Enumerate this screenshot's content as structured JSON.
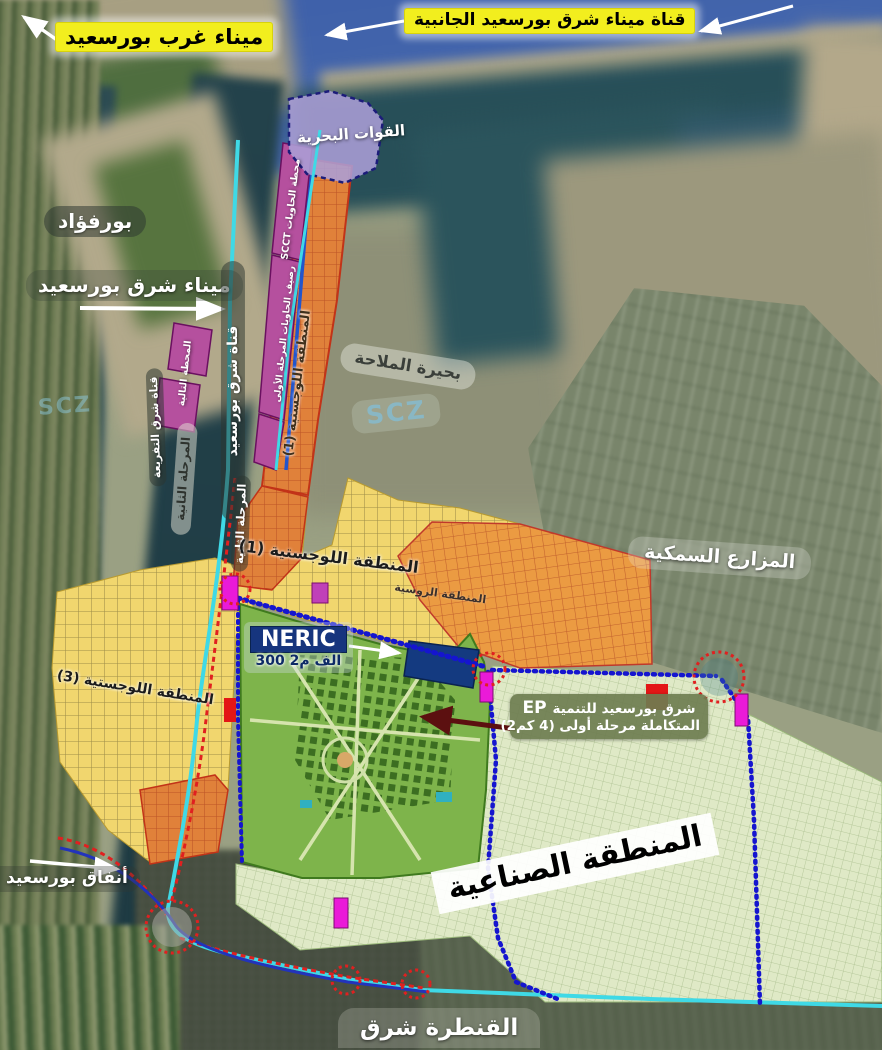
{
  "title": "East Port Said development master plan (satellite overlay)",
  "watermark": "SCZ",
  "labels": {
    "port_west": {
      "text": "ميناء غرب بورسعيد"
    },
    "side_canal": {
      "text": "قناة ميناء شرق بورسعيد الجانبية"
    },
    "navy_forces": {
      "text": "القوات البحرية"
    },
    "port_fuad": {
      "text": "بورفؤاد"
    },
    "port_east": {
      "text": "ميناء شرق بورسعيد"
    },
    "canal_east": {
      "text": "قناة شرق بورسعيد"
    },
    "canal_branch": {
      "text": "قناة شرق التفريعة"
    },
    "phase2_west": {
      "text": "المرحلة الثانية"
    },
    "phase2_east": {
      "text": "المرحلة الثانية"
    },
    "scct_terminal": {
      "text": "محطة الحاويات SCCT"
    },
    "container_quay": {
      "text": "رصيف الحاويات المرحلة الأولى"
    },
    "next_terminal": {
      "text": "المحطة التالية"
    },
    "logistics_zone_1_strip": {
      "text": "المنطقة اللوجستية (1)"
    },
    "mallaha_lake": {
      "text": "بحيرة الملاحة"
    },
    "logistics_zone_1": {
      "text": "المنطقة اللوجستية (1)"
    },
    "logistics_zone_3": {
      "text": "المنطقة اللوجستية (3)"
    },
    "russian_zone": {
      "text": "المنطقة الروسية"
    },
    "fish_farms": {
      "text": "المزارع السمكية"
    },
    "neric": {
      "title": "NERIC",
      "area": "300 الف م2"
    },
    "ep_dev": {
      "code": "EP",
      "line1": "شرق بورسعيد للتنمية",
      "line2": "المتكاملة مرحلة أولى (4 كم2)"
    },
    "industrial_zone": {
      "text": "المنطقة الصناعية"
    },
    "tunnels": {
      "text": "أنفاق بورسعيد"
    },
    "qantara_east": {
      "text": "القنطرة شرق"
    }
  },
  "colors": {
    "sea": "#3e61ab",
    "lake": "#2b545c",
    "logistics_yellow": "#f1d66e",
    "logistics_strip_orange": "#e0813a",
    "russian_orange": "#eb9b42",
    "container_terminal_magenta": "#b5509e",
    "navy_zone_purple": "#ab9ed6",
    "ep_green": "#7eb44b",
    "industrial_pale_green": "#dfe9c6",
    "neric_navy": "#16357e",
    "road_cyan": "#3fd9e6",
    "road_blue_dotted": "#1515cf",
    "road_red_dotted": "#e02020",
    "highlight_yellow": "#f2ee1e"
  }
}
